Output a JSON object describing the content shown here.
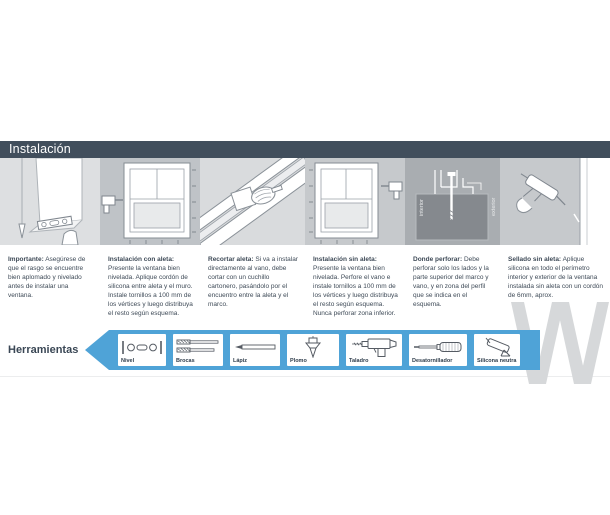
{
  "header": {
    "title": "Instalación"
  },
  "steps": [
    {
      "title": "Importante:",
      "body": "Asegúrese de que el rasgo se encuentre bien aplomado y nivelado antes de instalar una ventana."
    },
    {
      "title": "Instalación con aleta:",
      "body": "Presente la ventana bien nivelada. Aplique cordón de silicona entre aleta y el muro. Instale tornillos a 100 mm de los vértices y luego distribuya el resto según esquema."
    },
    {
      "title": "Recortar aleta:",
      "body": "Si va a instalar directamente al vano, debe cortar con un cuchillo cartonero, pasándolo por el encuentro entre la aleta y el marco."
    },
    {
      "title": "Instalación sin aleta:",
      "body": "Presente la ventana bien nivelada. Perfore el vano e instale tornillos a 100 mm de los vértices y luego distribuya el resto según esquema. Nunca perforar zona inferior."
    },
    {
      "title": "Donde perforar:",
      "body": "Debe perforar solo los lados y la parte superior del marco y vano, y en zona del perfil que se indica en el esquema.",
      "diagram_labels": {
        "left": "interior",
        "right": "exterior"
      }
    },
    {
      "title": "Sellado sin aleta:",
      "body": "Aplique silicona en todo el perímetro interior y exterior de la ventana instalada sin aleta con un cordón de 6mm, aprox."
    }
  ],
  "tools": {
    "label": "Herramientas",
    "items": [
      {
        "name": "Nivel",
        "icon": "level-icon"
      },
      {
        "name": "Brocas",
        "icon": "drill-bits-icon"
      },
      {
        "name": "Lápiz",
        "icon": "pencil-icon"
      },
      {
        "name": "Plomo",
        "icon": "plumb-bob-icon"
      },
      {
        "name": "Taladro",
        "icon": "drill-icon"
      },
      {
        "name": "Desatornillador",
        "icon": "screwdriver-icon"
      },
      {
        "name": "Silicona neutra",
        "icon": "caulking-gun-icon"
      }
    ]
  },
  "colors": {
    "header_bg": "#414E5C",
    "band_blue": "#4FA3D7",
    "text": "#3E4A57",
    "watermark": "#D6D8DA"
  }
}
